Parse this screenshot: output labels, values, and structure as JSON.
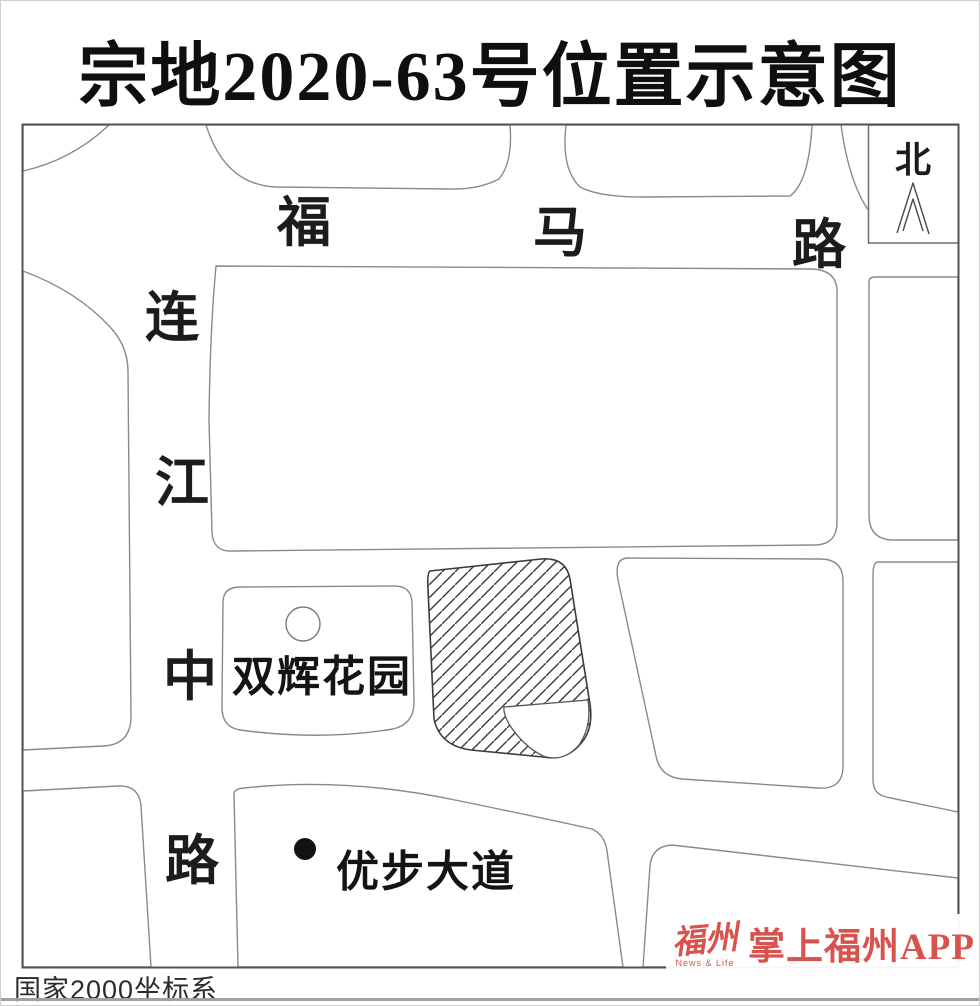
{
  "page": {
    "title": "宗地2020-63号位置示意图",
    "footer_note": "国家2000坐标系"
  },
  "compass": {
    "label": "北"
  },
  "roads": {
    "fuma": {
      "name": "福马路",
      "chars": [
        "福",
        "马",
        "路"
      ]
    },
    "lianjiang": {
      "name": "连江中路",
      "chars": [
        "连",
        "江",
        "中",
        "路"
      ]
    }
  },
  "landmarks": {
    "shuanghui_garden": {
      "label": "双辉花园"
    },
    "youbu_avenue": {
      "label": "优步大道"
    }
  },
  "watermark": {
    "logo": "福州",
    "logo_sub": "News & Life",
    "app": "掌上福州APP"
  },
  "colors": {
    "block_outline_gray": "#8a8a8a",
    "map_border": "#525252",
    "hatch_line": "#3c3c3c",
    "label_text": "#1c1c1c",
    "watermark_red": "#d8534d"
  }
}
